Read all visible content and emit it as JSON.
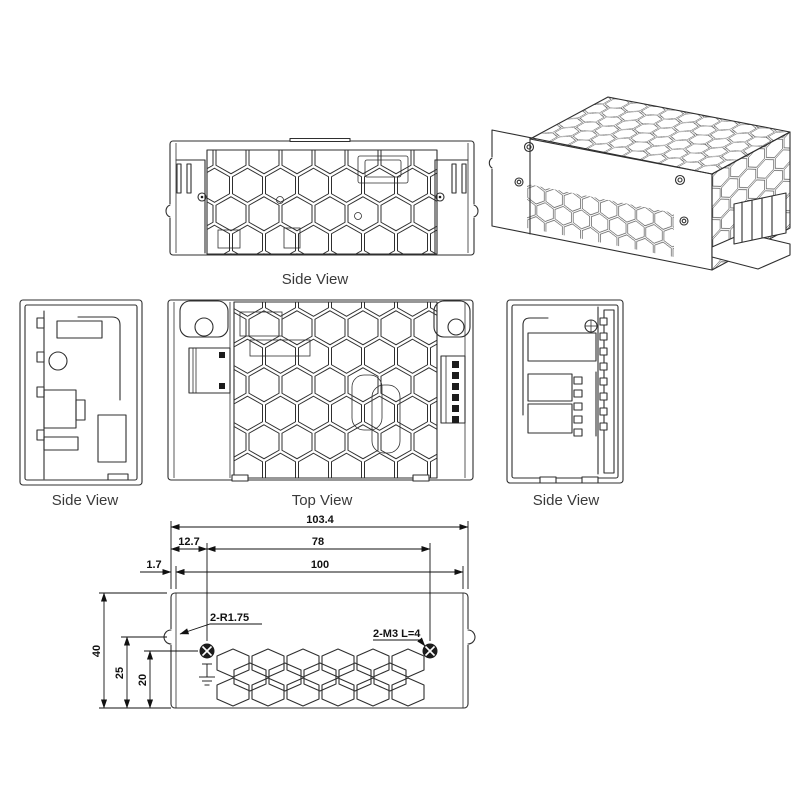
{
  "drawing": {
    "line_color": "#2f2f2f",
    "dim_color": "#111111",
    "views": {
      "side_top": {
        "label": "Side View"
      },
      "side_left": {
        "label": "Side View"
      },
      "top": {
        "label": "Top View"
      },
      "side_right": {
        "label": "Side View"
      }
    },
    "dimensions": {
      "overall_length": "103.4",
      "hole_offset": "12.7",
      "hole_spacing": "78",
      "flange_inset": "1.7",
      "body_length": "100",
      "overall_height": "40",
      "notch_height": "25",
      "hole_height": "20",
      "corner_radius_note": "2-R1.75",
      "screw_note": "2-M3 L=4"
    }
  }
}
